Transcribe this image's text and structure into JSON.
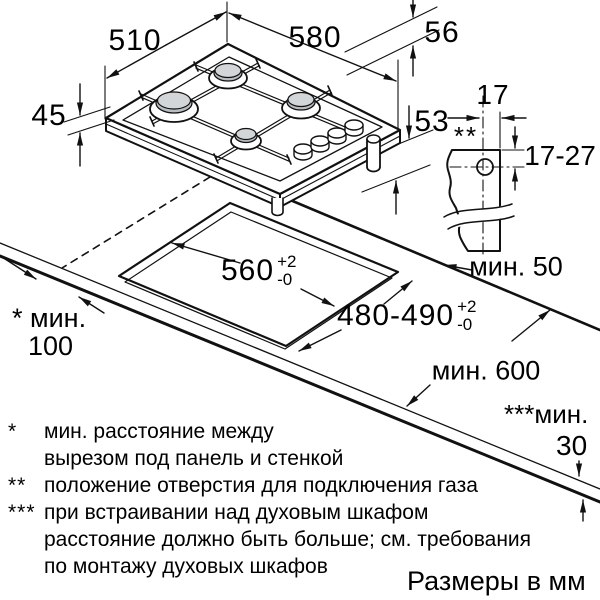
{
  "drawing": {
    "dim_510": "510",
    "dim_580": "580",
    "dim_56": "56",
    "dim_53": "53",
    "dim_45": "45",
    "dim_17": "17",
    "dim_17_27": "17-27",
    "gas_hole_marker": "**",
    "min_50": "мин. 50",
    "min_600": "мин. 600",
    "min_100_label": "* мин.",
    "min_100_value": "100",
    "min_30_label": "***мин.",
    "min_30_value": "30",
    "cutout_width": "560",
    "cutout_width_tol": {
      "plus": "+2",
      "minus": "-0"
    },
    "cutout_depth": "480-490",
    "cutout_depth_tol": {
      "plus": "+2",
      "minus": "-0"
    },
    "line_color": "#111111",
    "burner_cap_color": "#c7cbcf"
  },
  "footnotes": [
    {
      "marker": "*",
      "text": "мин. расстояние между"
    },
    {
      "marker": "",
      "text": "вырезом под панель и стенкой"
    },
    {
      "marker": "**",
      "text": "положение отверстия для подключения газа"
    },
    {
      "marker": "***",
      "text": "при встраивании над духовым шкафом"
    },
    {
      "marker": "",
      "text": "расстояние должно быть больше; см. требования"
    },
    {
      "marker": "",
      "text": "по монтажу духовых шкафов"
    }
  ],
  "units_note": "Размеры в мм"
}
